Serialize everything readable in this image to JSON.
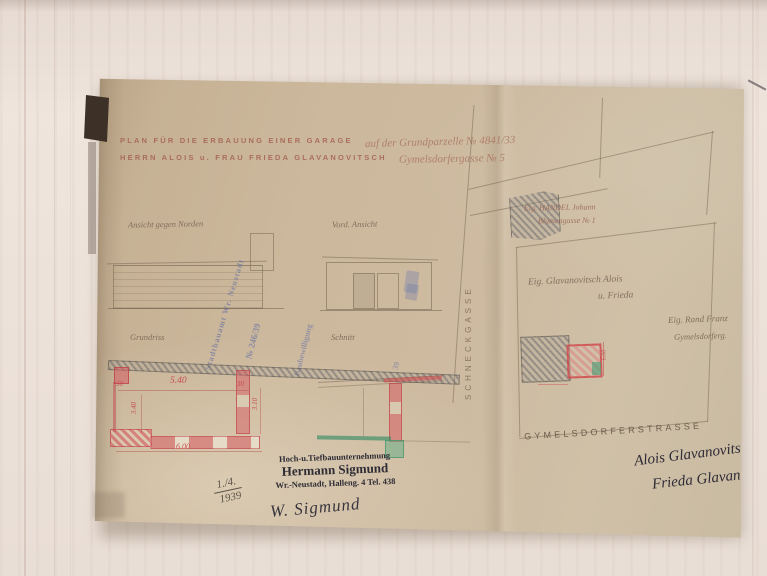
{
  "document": {
    "title": {
      "line1_typed": "PLAN FÜR DIE ERBAUUNG EINER GARAGE",
      "line1_hand": "auf der Grundparzelle № 4841/33",
      "line2_typed": "HERRN ALOIS u. FRAU FRIEDA GLAVANOVITSCH",
      "line2_hand": "Gymelsdorfergasse № 5"
    },
    "drawing_labels": {
      "elevation_left": "Ansicht gegen Norden",
      "elevation_front": "Vord. Ansicht",
      "floor_plan": "Grundriss",
      "section": "Schnitt"
    },
    "plan_dimensions": {
      "wall_left": "30",
      "span": "5.40",
      "wall_right": "30",
      "depth_inner": "3.40",
      "depth_right": "3.10",
      "width_total": "6.00"
    },
    "site": {
      "street_vertical": "SCHNECKGASSE",
      "street_bottom": "GYMELSDORFERSTRASSE",
      "neighbor_top_line1": "Eig. HANDEL Johann",
      "neighbor_top_line2": "Blumengasse № 1",
      "owner_line1": "Eig. Glavanovitsch Alois",
      "owner_line2": "u. Frieda",
      "neighbor_right_line1": "Eig. Rand Franz",
      "neighbor_right_line2": "Gymelsdorferg.",
      "garage_dim": "6.00"
    },
    "approval_stamps": {
      "blue1": "Stadtbauamt Wr. Neustadt",
      "blue2": "№ 246/39",
      "blue3": "Baubewilligung",
      "blue4": "39"
    },
    "builder_stamp": {
      "line1": "Hoch-u.Tiefbauunternehmung",
      "line2": "Hermann Sigmund",
      "line3": "Wr.-Neustadt, Halleng. 4  Tel. 438"
    },
    "date": {
      "numerator": "1./4.",
      "year": "1939"
    },
    "signatures": {
      "builder": "W. Sigmund",
      "owner1": "Alois Glavanovits",
      "owner2": "Frieda Glavan"
    }
  },
  "colors": {
    "paper": "#ccb89c",
    "wood": "#ece2da",
    "faded_red": "#a25e4e",
    "pencil": "#76654f",
    "wall_red": "#d45c62",
    "accent_green": "#3f8f6a",
    "stamp_blue": "#4c60a6",
    "ink_dark": "#2d2b33"
  }
}
